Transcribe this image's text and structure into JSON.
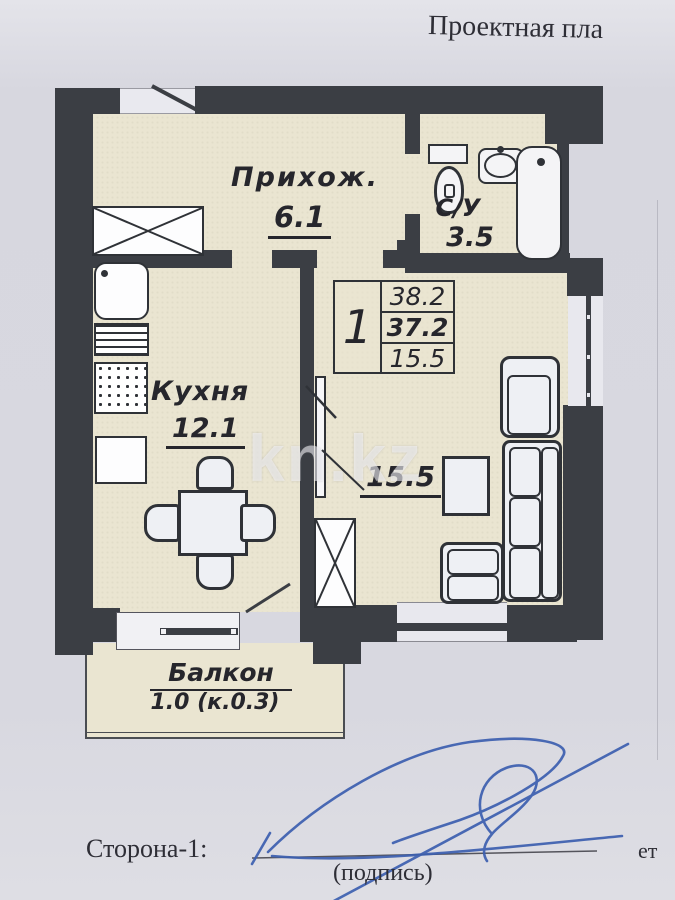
{
  "title": "Проектная пла",
  "watermark": "kn.kz",
  "info_table": {
    "number": "1",
    "rows": [
      "38.2",
      "37.2",
      "15.5"
    ]
  },
  "rooms": {
    "hallway": {
      "name": "Прихож.",
      "area": "6.1"
    },
    "bathroom": {
      "name": "С/У",
      "area": "3.5"
    },
    "kitchen": {
      "name": "Кухня",
      "area": "12.1"
    },
    "living": {
      "area": "15.5"
    },
    "balcony": {
      "name": "Балкон",
      "area": "1.0 (к.0.3)"
    }
  },
  "footer": {
    "side_label": "Сторона-1:",
    "signature_caption": "(подпись)",
    "right_partial": "ет"
  },
  "colors": {
    "wall": "#3b3e44",
    "floor": "#eae5d1",
    "paper": "#d8d8e0",
    "ink": "#26262c",
    "pen": "#3c5fb0"
  }
}
